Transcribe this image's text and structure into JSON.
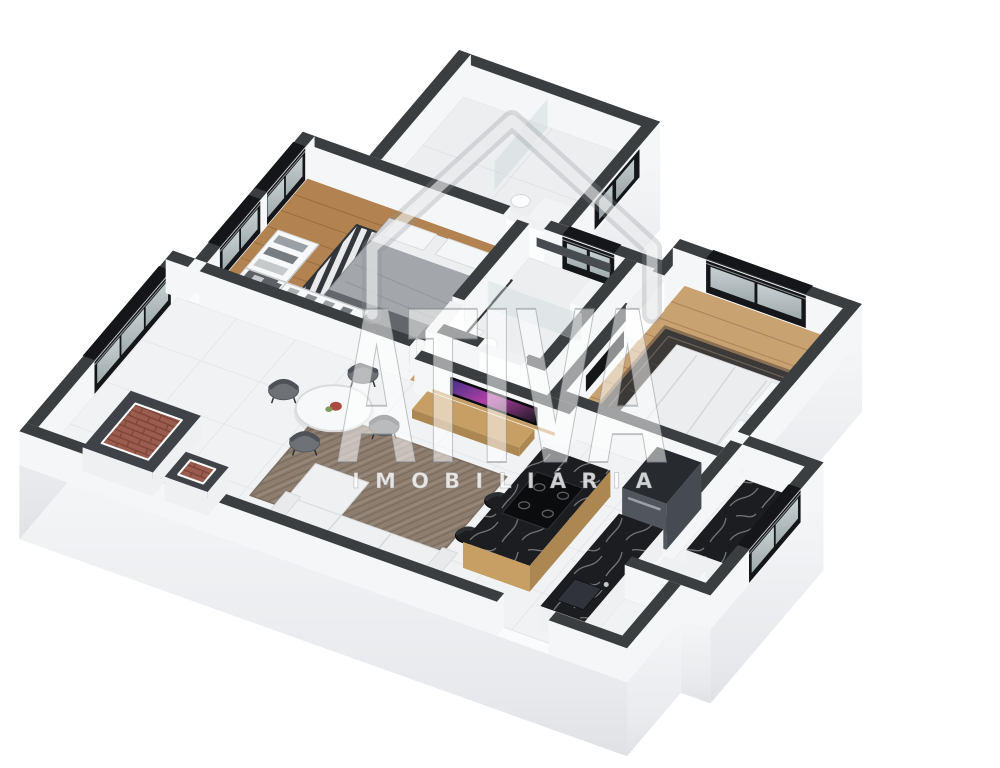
{
  "image": {
    "kind": "3D isometric floor plan rendering",
    "description": "Dollhouse cutaway render of a furnished two-bedroom apartment on a white background",
    "background": "#ffffff"
  },
  "watermark": {
    "brand": "ATIVA",
    "tagline": "IMOBILIÁRIA"
  },
  "palette": {
    "wall_top": "#3a3e41",
    "wall_face": "#f5f6f7",
    "window_frame": "#141619",
    "glass_light": "#d6dfe0",
    "glass_dark": "#a9b5b8",
    "slab_light": "#f4f5f7",
    "slab_dark": "#dfe1e4",
    "tile_floor": "#f1f2f4",
    "tile_line": "#e3e5e8",
    "marble_floor": "#eceef0",
    "wood_floor": "#b2referenced",
    "wood_floor_bedroom": "#b28350",
    "wood_hall": "#c59e6c",
    "wood_furniture": "#c79e63",
    "wood_furniture_dark": "#ad8752",
    "counter_marble": "#1b1d20",
    "brick": "#9a5c4e",
    "rug_living": "#8d7e70",
    "rug_bedroom_right": "#3c3a38",
    "rug_stripe_dark": "#33373b",
    "sofa": "#eff0f2",
    "bed_gray": "#a3a7ab",
    "bed_white": "#ebedee",
    "chair_gray": "#6e7276",
    "stool_black": "#1b1d1f",
    "fridge_steel": "#51565c",
    "tv_screen_accent": "#b13fa4"
  },
  "rooms": [
    {
      "name": "top bathroom",
      "features": [
        "walk-in shower with glass partition",
        "toilet",
        "vanity",
        "small black window",
        "marble walls"
      ]
    },
    {
      "name": "left bedroom",
      "features": [
        "double bed with gray duvet",
        "striped rug",
        "open wardrobe shelving",
        "two black-framed windows",
        "wood floor"
      ]
    },
    {
      "name": "middle bathroom",
      "features": [
        "shower glass",
        "toilet",
        "wall niche",
        "small black window",
        "marble walls"
      ]
    },
    {
      "name": "right bedroom",
      "features": [
        "double bed with white duvet",
        "dark rug",
        "wall TV",
        "wardrobe shelving",
        "black-framed window"
      ]
    },
    {
      "name": "living and dining room",
      "features": [
        "round dining table with four gray chairs",
        "white sofa with chaise",
        "taupe herringbone rug",
        "TV panel with wood shelf",
        "large black-framed window",
        "two brick-lined shafts"
      ]
    },
    {
      "name": "kitchen",
      "features": [
        "wood island with black marble top and cooktop",
        "two black stools",
        "black marble counter with sink",
        "refrigerator"
      ]
    },
    {
      "name": "service area",
      "features": [
        "black-framed window",
        "black marble counter",
        "washer"
      ]
    }
  ]
}
